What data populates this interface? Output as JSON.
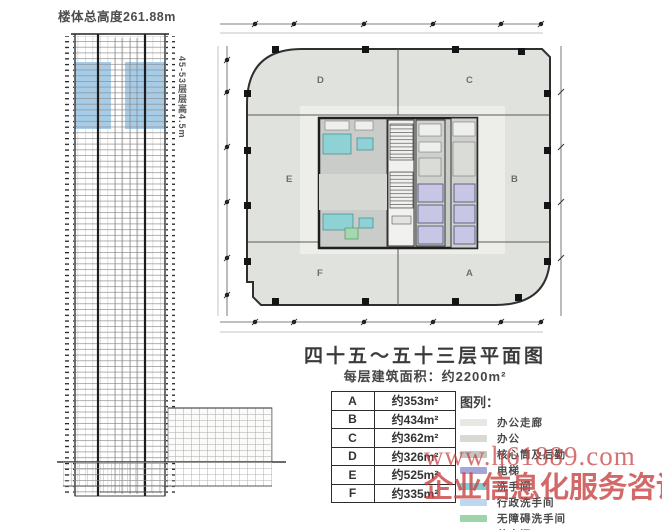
{
  "elevation": {
    "total_height_label": "楼体总高度261.88m",
    "highlight_floors_label": "45-53层层高4.5m"
  },
  "plan": {
    "zone_labels": [
      "D",
      "C",
      "E",
      "B",
      "F",
      "A"
    ]
  },
  "title": "四十五～五十三层平面图",
  "subtitle": "每层建筑面积：约2200m²",
  "area_table": {
    "rows": [
      {
        "zone": "A",
        "area": "约353m²"
      },
      {
        "zone": "B",
        "area": "约434m²"
      },
      {
        "zone": "C",
        "area": "约362m²"
      },
      {
        "zone": "D",
        "area": "约326m²"
      },
      {
        "zone": "E",
        "area": "约525m²"
      },
      {
        "zone": "F",
        "area": "约335m²"
      }
    ]
  },
  "legend": {
    "header": "图列：",
    "items": [
      {
        "label": "办公走廊",
        "color": "#e7e8e4"
      },
      {
        "label": "办公",
        "color": "#d8d9d5"
      },
      {
        "label": "核心筒及后勤",
        "color": "#c3c5c1"
      },
      {
        "label": "电梯",
        "color": "#a3a6d6"
      },
      {
        "label": "洗手间",
        "color": "#7fd0d4"
      },
      {
        "label": "行政洗手间",
        "color": "#bdd7ee"
      },
      {
        "label": "无障碍洗手间",
        "color": "#9ed4aa"
      },
      {
        "label": "茶水间",
        "color": "#7fa8dc"
      }
    ]
  },
  "watermark": {
    "line1": "www.h61889.com",
    "line2": "企业信息化服务咨询"
  },
  "colors": {
    "plan_office_fill": "#e0e2de",
    "corridor_fill": "#edeeea",
    "core_fill": "#c9ccc8",
    "elevator_fill": "#c7c6e4",
    "restroom_fill": "#8fd2d6",
    "accessible_fill": "#a5d8ae",
    "highlight_band": "#a5cdea",
    "watermark_red": "#c94343"
  }
}
